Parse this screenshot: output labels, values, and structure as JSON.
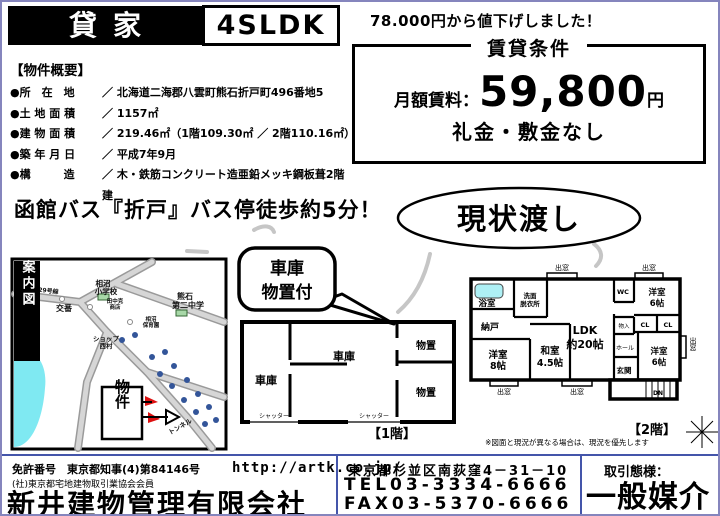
{
  "header": {
    "type_label": "貸家",
    "layout_label": "4SLDK"
  },
  "price": {
    "discount_note": "78.000円から値下げしました！",
    "box_title": "賃貸条件",
    "rent_label": "月額賃料：",
    "rent_value": "59,800",
    "rent_unit": "円",
    "deposit_note": "礼金・敷金なし",
    "original_price": "78,000"
  },
  "overview": {
    "title": "【物件概要】",
    "rows": [
      {
        "label": "●所　在　地",
        "value": "／ 北海道二海郡八雲町熊石折戸町496番地5"
      },
      {
        "label": "●土 地 面 積",
        "value": "／ 1157㎡"
      },
      {
        "label": "●建 物 面 積",
        "value": "／ 219.46㎡（1階109.30㎡ ／ 2階110.16㎡）"
      },
      {
        "label": "●築 年 月 日",
        "value": "／ 平成7年9月"
      },
      {
        "label": "●構　　　造",
        "value": "／ 木・鉄筋コンクリート造亜鉛メッキ鋼板葺2階建"
      }
    ]
  },
  "access_note": "函館バス『折戸』バス停徒歩約5分！",
  "badges": {
    "as_is": "現状渡し",
    "bubble_line1": "車庫",
    "bubble_line2": "物置付"
  },
  "map": {
    "side_label": "現地案内図",
    "road": "国道229号線",
    "elementary_l1": "相沼",
    "elementary_l2": "小学校",
    "junior_l1": "熊石",
    "junior_l2": "第二中学",
    "police": "交番",
    "store_l1": "田中克",
    "store_l2": "商店",
    "nursery_l1": "相沼",
    "nursery_l2": "保育園",
    "shop_l1": "ショップ",
    "shop_l2": "西村",
    "property": "物件",
    "tunnel": "トンネル"
  },
  "fp1": {
    "garage": "車庫",
    "storage": "物置",
    "shutter": "シャッター",
    "floor_label": "【1階】"
  },
  "fp2": {
    "bay_window": "出窓",
    "bath": "浴室",
    "wash_l1": "洗面",
    "wash_l2": "脱衣所",
    "wc": "WC",
    "closet": "納戸",
    "western": "洋室",
    "eight_jo": "8帖",
    "six_jo": "6帖",
    "japanese": "和室",
    "four_half_jo": "4.5帖",
    "ldk_l1": "LDK",
    "ldk_l2": "約20帖",
    "cl": "CL",
    "mono_iri": "物入",
    "hall": "ホール",
    "entrance": "玄関",
    "dn": "DN",
    "floor_label": "【2階】",
    "note": "※図面と現況が異なる場合は、現況を優先します"
  },
  "footer": {
    "license_line1": "免許番号　東京都知事(4)第84146号",
    "license_line2": "(社)東京都宅地建物取引業協会会員",
    "company": "新井建物管理有限会社",
    "url": "http://artk.co.jp/",
    "address": "東京都杉並区南荻窪4－31－10",
    "tel": "TEL03-3334-6666",
    "fax": "FAX03-5370-6666",
    "transaction_label": "取引態様：",
    "transaction_type": "一般媒介"
  },
  "colors": {
    "frame": "#8585bd",
    "divider": "#4455aa",
    "water": "#7fe9f2",
    "road": "#c9c9c9",
    "marker_red": "#dd1111",
    "house_dot": "#335599"
  }
}
